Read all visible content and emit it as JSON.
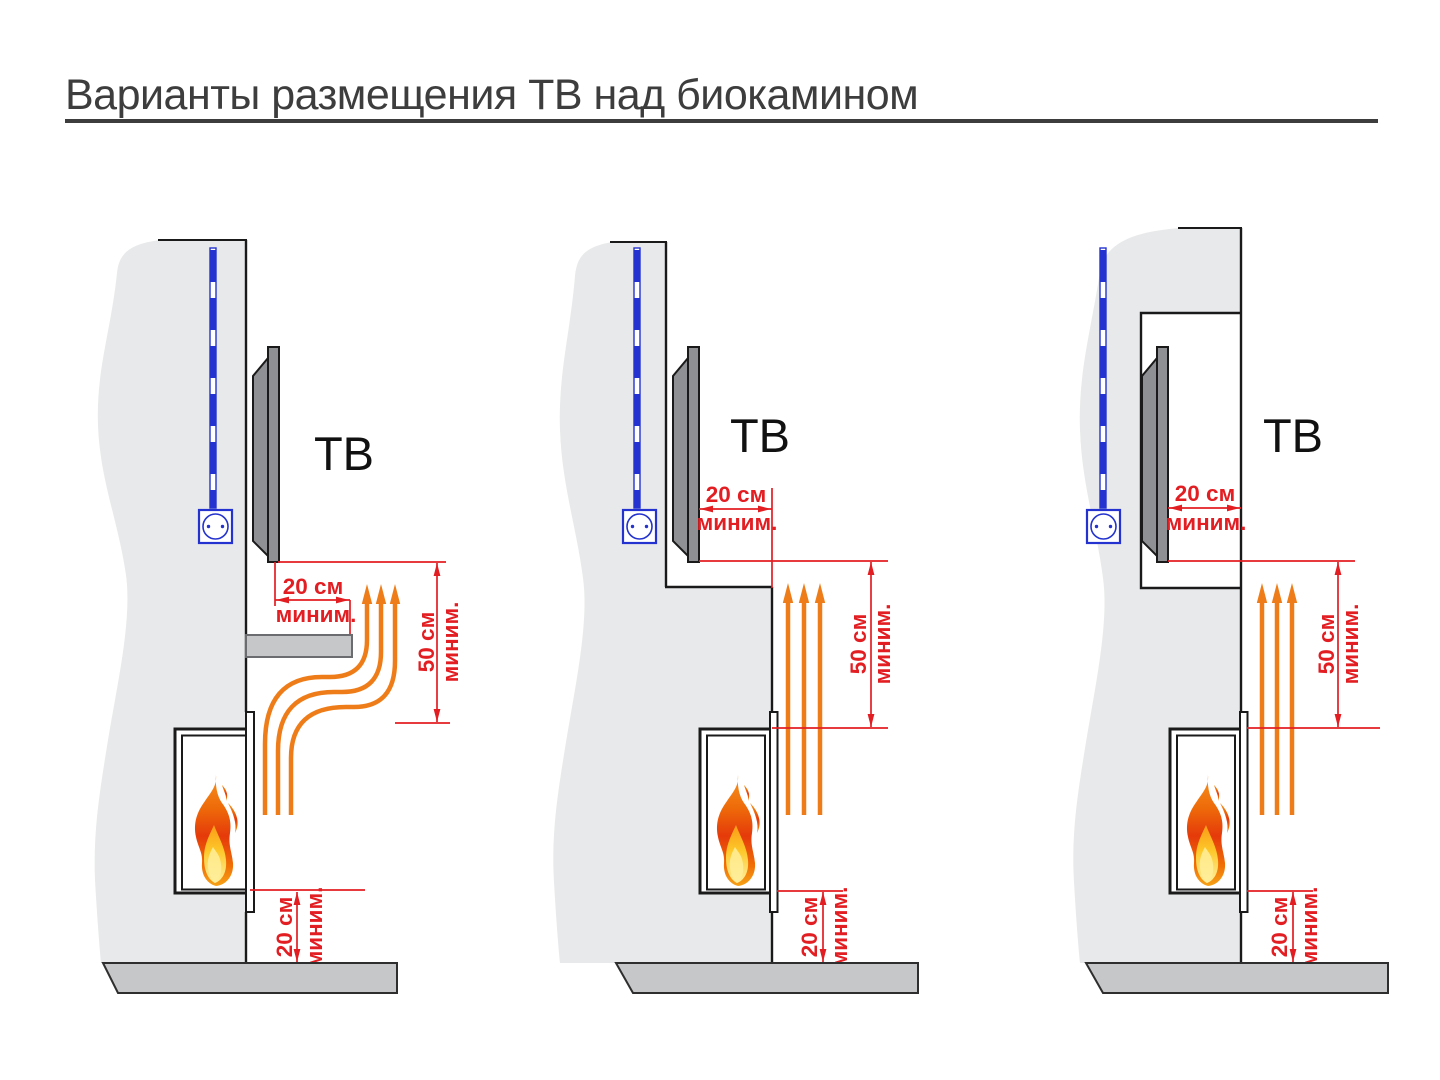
{
  "title": "Варианты размещения ТВ над биокамином",
  "colors": {
    "title_text": "#3d3d3d",
    "dimension_red": "#e21e23",
    "heat_arrow_orange": "#ee7d19",
    "cable_blue": "#2433cf",
    "wall_gray": "#e8e9ea",
    "tv_panel_gray": "#8e9093",
    "floor_gray": "#c6c7c9"
  },
  "diagrams": [
    {
      "tv_label": "ТВ",
      "offset_dim": {
        "value": "20 см",
        "qualifier": "миним."
      },
      "clearance_dim": {
        "value": "50 см",
        "qualifier": "миним."
      },
      "floor_dim": {
        "value": "20 см",
        "qualifier": "миним."
      }
    },
    {
      "tv_label": "ТВ",
      "offset_dim": {
        "value": "20 см",
        "qualifier": "миним."
      },
      "clearance_dim": {
        "value": "50 см",
        "qualifier": "миним."
      },
      "floor_dim": {
        "value": "20 см",
        "qualifier": "миним."
      }
    },
    {
      "tv_label": "ТВ",
      "offset_dim": {
        "value": "20 см",
        "qualifier": "миним."
      },
      "clearance_dim": {
        "value": "50 см",
        "qualifier": "миним."
      },
      "floor_dim": {
        "value": "20 см",
        "qualifier": "миним."
      }
    }
  ]
}
